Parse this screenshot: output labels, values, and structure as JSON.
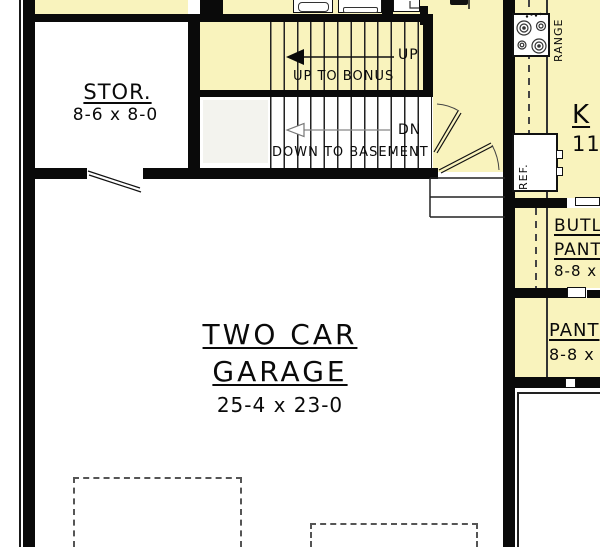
{
  "colors": {
    "room_fill": "#F9F3BD",
    "wall": "#0a0a0a",
    "dashed_outline": "#555555"
  },
  "rooms": {
    "storage": {
      "name": "STOR.",
      "dims": "8-6 x 8-0"
    },
    "garage": {
      "name_line1": "TWO CAR",
      "name_line2": "GARAGE",
      "dims": "25-4 x 23-0"
    },
    "kitchen": {
      "name": "K",
      "dims": "11"
    },
    "butlers_pantry": {
      "name_line1": "BUTL",
      "name_line2": "PANT",
      "dims": "8-8 x"
    },
    "pantry": {
      "name": "PANT",
      "dims": "8-8 x"
    }
  },
  "stairs": {
    "up_label": "UP",
    "up_note": "UP TO BONUS",
    "down_label": "DN",
    "down_note": "DOWN TO BASEMENT"
  },
  "appliances": {
    "range_label": "RANGE",
    "refrigerator_label": "REF."
  }
}
